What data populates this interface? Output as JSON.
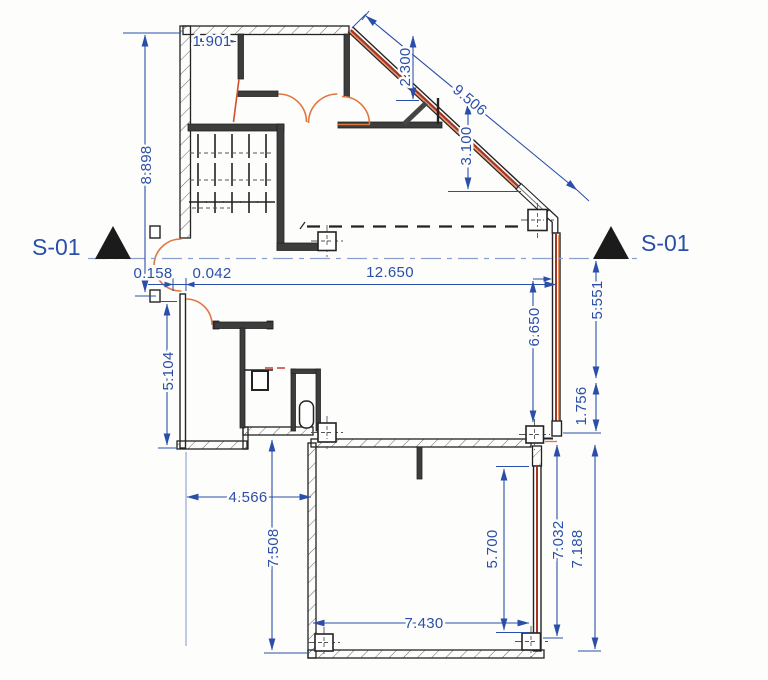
{
  "drawing": {
    "type": "architectural floor plan with section cut S-01",
    "section_markers": {
      "left": "S-01",
      "right": "S-01"
    },
    "dims": {
      "w1901": "1.901",
      "h8898": "8.898",
      "v2300": "2.300",
      "diag9506": "9.506",
      "v3100": "3.100",
      "w0158": "0.158",
      "w0042": "0.042",
      "w12650": "12.650",
      "h5551": "5.551",
      "h6650": "6.650",
      "h1756": "1.756",
      "h5104": "5.104",
      "w4566": "4.566",
      "h7508": "7.508",
      "h5700": "5.700",
      "w7430": "7.430",
      "h7032": "7.032",
      "h7188": "7.188"
    },
    "colors": {
      "dimension_blue": "#2b4fa8",
      "section_line_blue": "#8ba0cf",
      "wall_ink": "#232323",
      "door_orange": "#e2763f",
      "glazing_red": "#a83524",
      "glazing_orange": "#e2905e",
      "marker_fill": "#1b1b1b",
      "paper": "#fdfdfc"
    }
  }
}
